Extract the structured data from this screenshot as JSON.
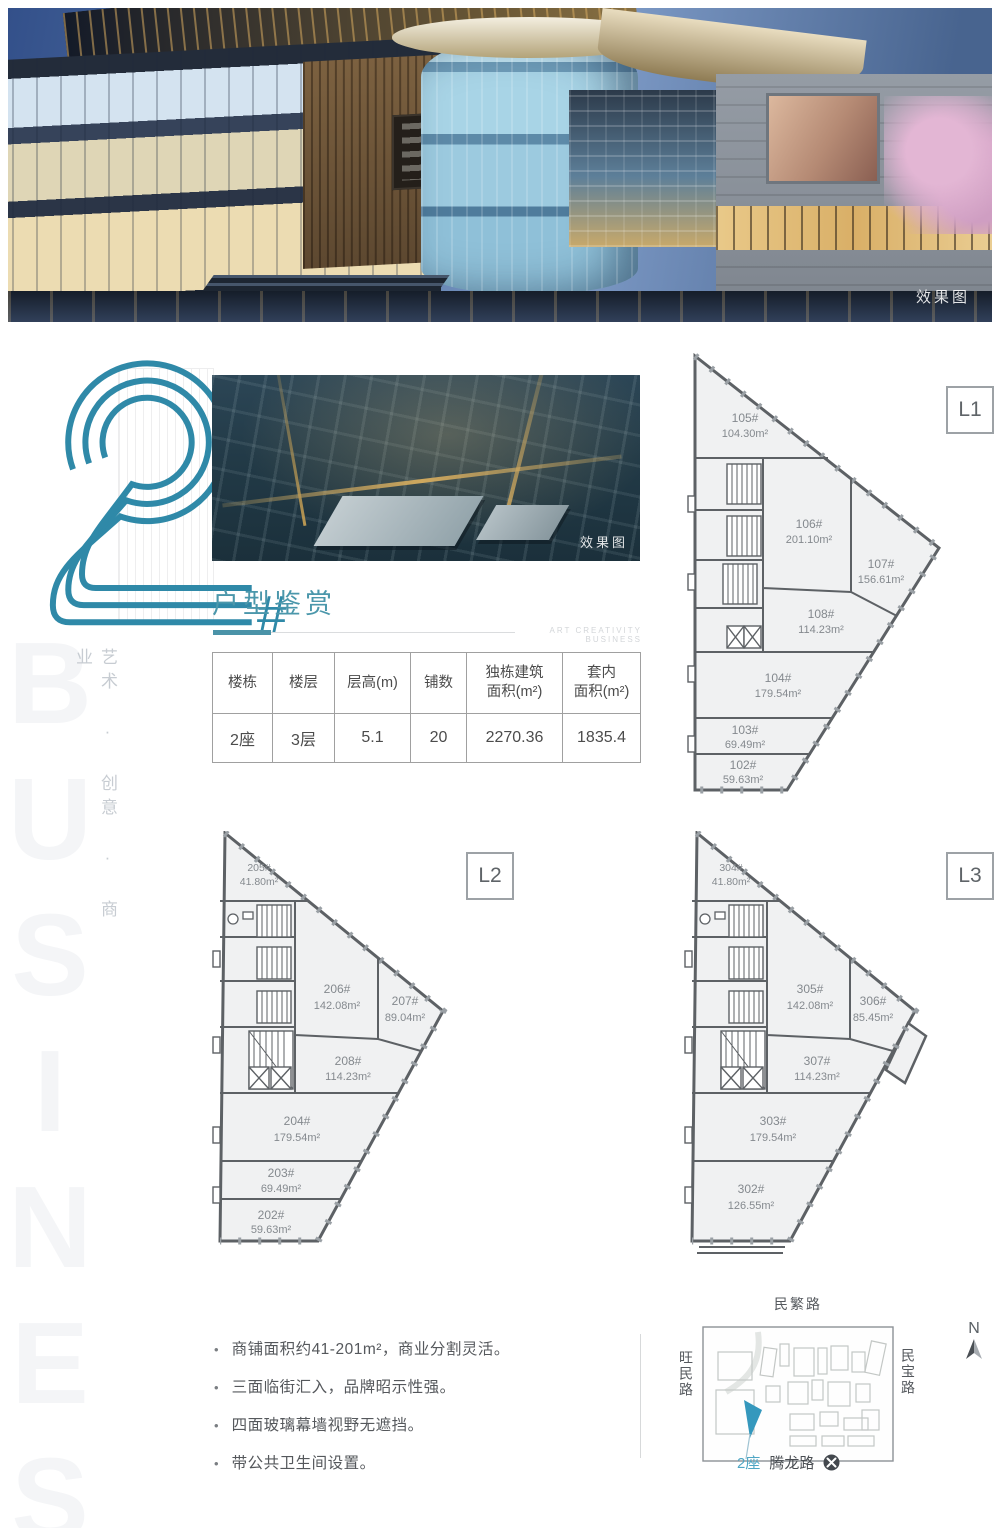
{
  "hero": {
    "caption": "效果图"
  },
  "logo": {
    "numeral": "2",
    "suffix": "#"
  },
  "side": {
    "slogan": "艺术 · 创意 · 商业",
    "watermark": "BUSINESS"
  },
  "aerial": {
    "caption": "效果图"
  },
  "section": {
    "title": "户型鉴赏",
    "tagline": "ART CREATIVITY BUSINESS"
  },
  "spec_table": {
    "headers": [
      "楼栋",
      "楼层",
      "层高(m)",
      "铺数",
      "独栋建筑\n面积(m²)",
      "套内\n面积(m²)"
    ],
    "row": [
      "2座",
      "3层",
      "5.1",
      "20",
      "2270.36",
      "1835.4"
    ]
  },
  "plans": {
    "l1": {
      "tag": "L1",
      "units": [
        {
          "id": "105#",
          "area": "104.30m²"
        },
        {
          "id": "106#",
          "area": "201.10m²"
        },
        {
          "id": "107#",
          "area": "156.61m²"
        },
        {
          "id": "108#",
          "area": "114.23m²"
        },
        {
          "id": "104#",
          "area": "179.54m²"
        },
        {
          "id": "103#",
          "area": "69.49m²"
        },
        {
          "id": "102#",
          "area": "59.63m²"
        }
      ]
    },
    "l2": {
      "tag": "L2",
      "units": [
        {
          "id": "205#",
          "area": "41.80m²"
        },
        {
          "id": "206#",
          "area": "142.08m²"
        },
        {
          "id": "207#",
          "area": "89.04m²"
        },
        {
          "id": "208#",
          "area": "114.23m²"
        },
        {
          "id": "204#",
          "area": "179.54m²"
        },
        {
          "id": "203#",
          "area": "69.49m²"
        },
        {
          "id": "202#",
          "area": "59.63m²"
        }
      ]
    },
    "l3": {
      "tag": "L3",
      "units": [
        {
          "id": "304#",
          "area": "41.80m²"
        },
        {
          "id": "305#",
          "area": "142.08m²"
        },
        {
          "id": "306#",
          "area": "85.45m²"
        },
        {
          "id": "307#",
          "area": "114.23m²"
        },
        {
          "id": "303#",
          "area": "179.54m²"
        },
        {
          "id": "302#",
          "area": "126.55m²"
        }
      ]
    }
  },
  "features": {
    "bullet": "•",
    "items": [
      "商铺面积约41-201m²，商业分割灵活。",
      "三面临街汇入，品牌昭示性强。",
      "四面玻璃幕墙视野无遮挡。",
      "带公共卫生间设置。"
    ]
  },
  "map": {
    "road_top": "民繁路",
    "road_left": "旺民路",
    "road_right": "民宝路",
    "station_road": "腾龙路",
    "building_label": "2座",
    "north": "N"
  },
  "colors": {
    "accent": "#2f89a8",
    "title": "#4b97ab",
    "highlight": "#3598bd"
  }
}
